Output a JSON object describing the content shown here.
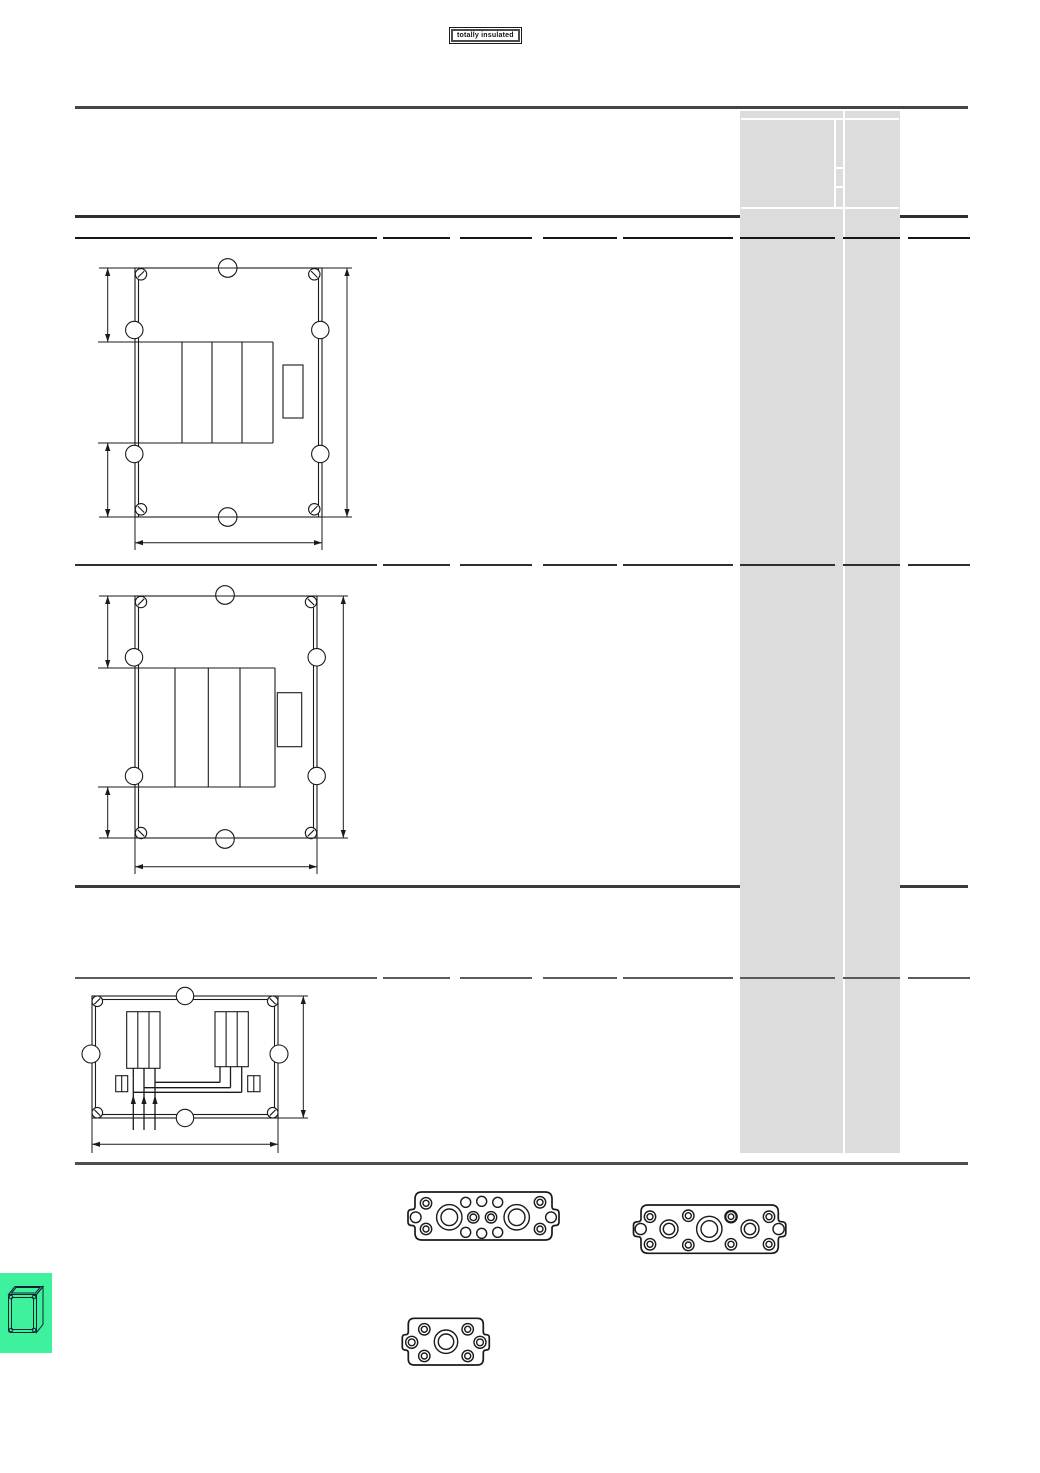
{
  "document": {
    "badge_label": "totally insulated",
    "page_width": 1040,
    "page_height": 1473
  },
  "colors": {
    "highlight_column": "#dcdcdc",
    "ink": "#1a1a1a",
    "rule_dark": "#2f2f2f",
    "tab_green": "#3ef29d",
    "paper": "#ffffff"
  },
  "table": {
    "column_segments": [
      [
        75,
        377
      ],
      [
        383,
        450
      ],
      [
        460,
        532
      ],
      [
        543,
        617
      ],
      [
        623,
        733
      ],
      [
        740,
        835
      ],
      [
        843,
        900
      ],
      [
        908,
        970
      ]
    ],
    "divider_rows": [
      {
        "y": 237,
        "color": "#161616"
      },
      {
        "y": 564,
        "color": "#2f2f2f"
      },
      {
        "y": 977,
        "color": "#5a5a5a"
      }
    ],
    "cells_text": []
  },
  "figures": {
    "drawing1": "enclosure-top-view-tall-1",
    "drawing2": "enclosure-top-view-tall-2",
    "drawing3": "enclosure-top-view-wide-wired",
    "gasket1": "flange-plate-multi-hole-a",
    "gasket2": "flange-plate-multi-hole-b",
    "gasket3": "flange-plate-small",
    "tab_icon": "enclosure-3d-icon"
  }
}
